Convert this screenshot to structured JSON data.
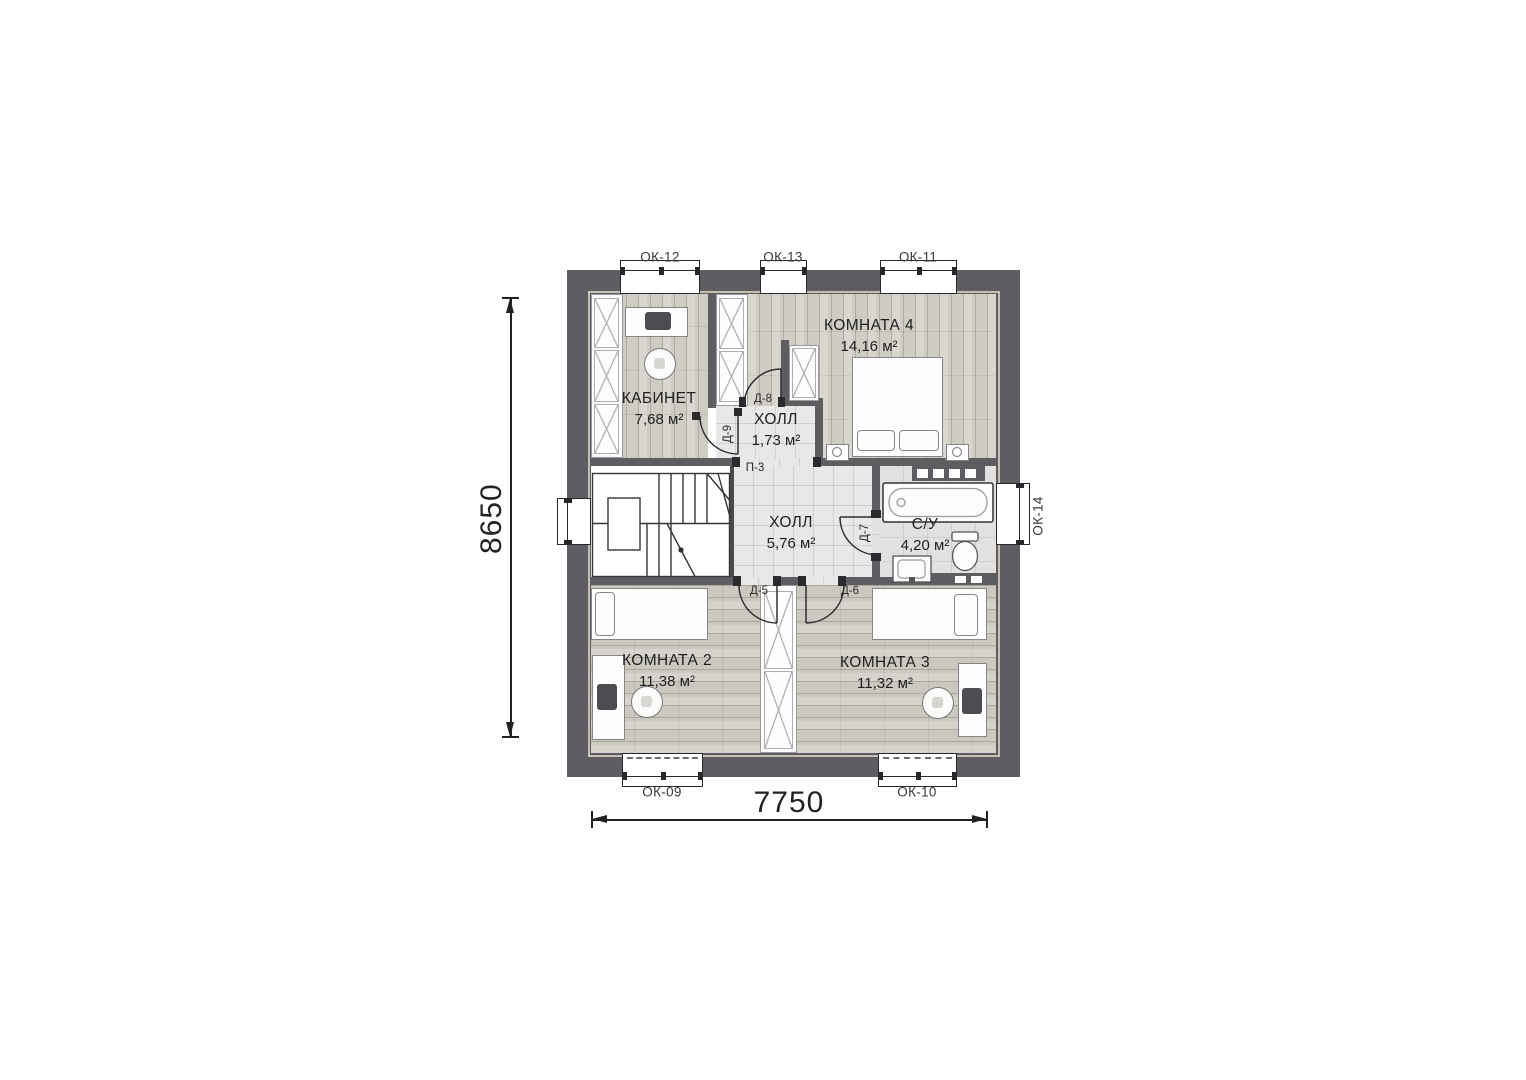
{
  "plan": {
    "rooms": [
      {
        "name": "КАБИНЕТ",
        "area": "7,68 м²"
      },
      {
        "name": "ХОЛЛ",
        "area": "1,73 м²"
      },
      {
        "name": "КОМНАТА 4",
        "area": "14,16 м²"
      },
      {
        "name": "ХОЛЛ",
        "area": "5,76 м²"
      },
      {
        "name": "С/У",
        "area": "4,20 м²"
      },
      {
        "name": "КОМНАТА 2",
        "area": "11,38 м²"
      },
      {
        "name": "КОМНАТА 3",
        "area": "11,32 м²"
      }
    ],
    "windows": [
      {
        "label": "ОК-12"
      },
      {
        "label": "ОК-13"
      },
      {
        "label": "ОК-11"
      },
      {
        "label": "ОК-14"
      },
      {
        "label": "ОК-09"
      },
      {
        "label": "ОК-10"
      }
    ],
    "doors": [
      {
        "label": "Д-8"
      },
      {
        "label": "Д-9"
      },
      {
        "label": "П-3"
      },
      {
        "label": "Д-7"
      },
      {
        "label": "Д-5"
      },
      {
        "label": "Д-6"
      }
    ],
    "dimensions": {
      "height": "8650",
      "width": "7750"
    },
    "colors": {
      "wall": "#5e5e62",
      "wood_floor": "#cfccc3",
      "tile_floor": "#e9e8e6",
      "stone_floor": "#e2e1df",
      "text": "#2d2d2d"
    }
  }
}
